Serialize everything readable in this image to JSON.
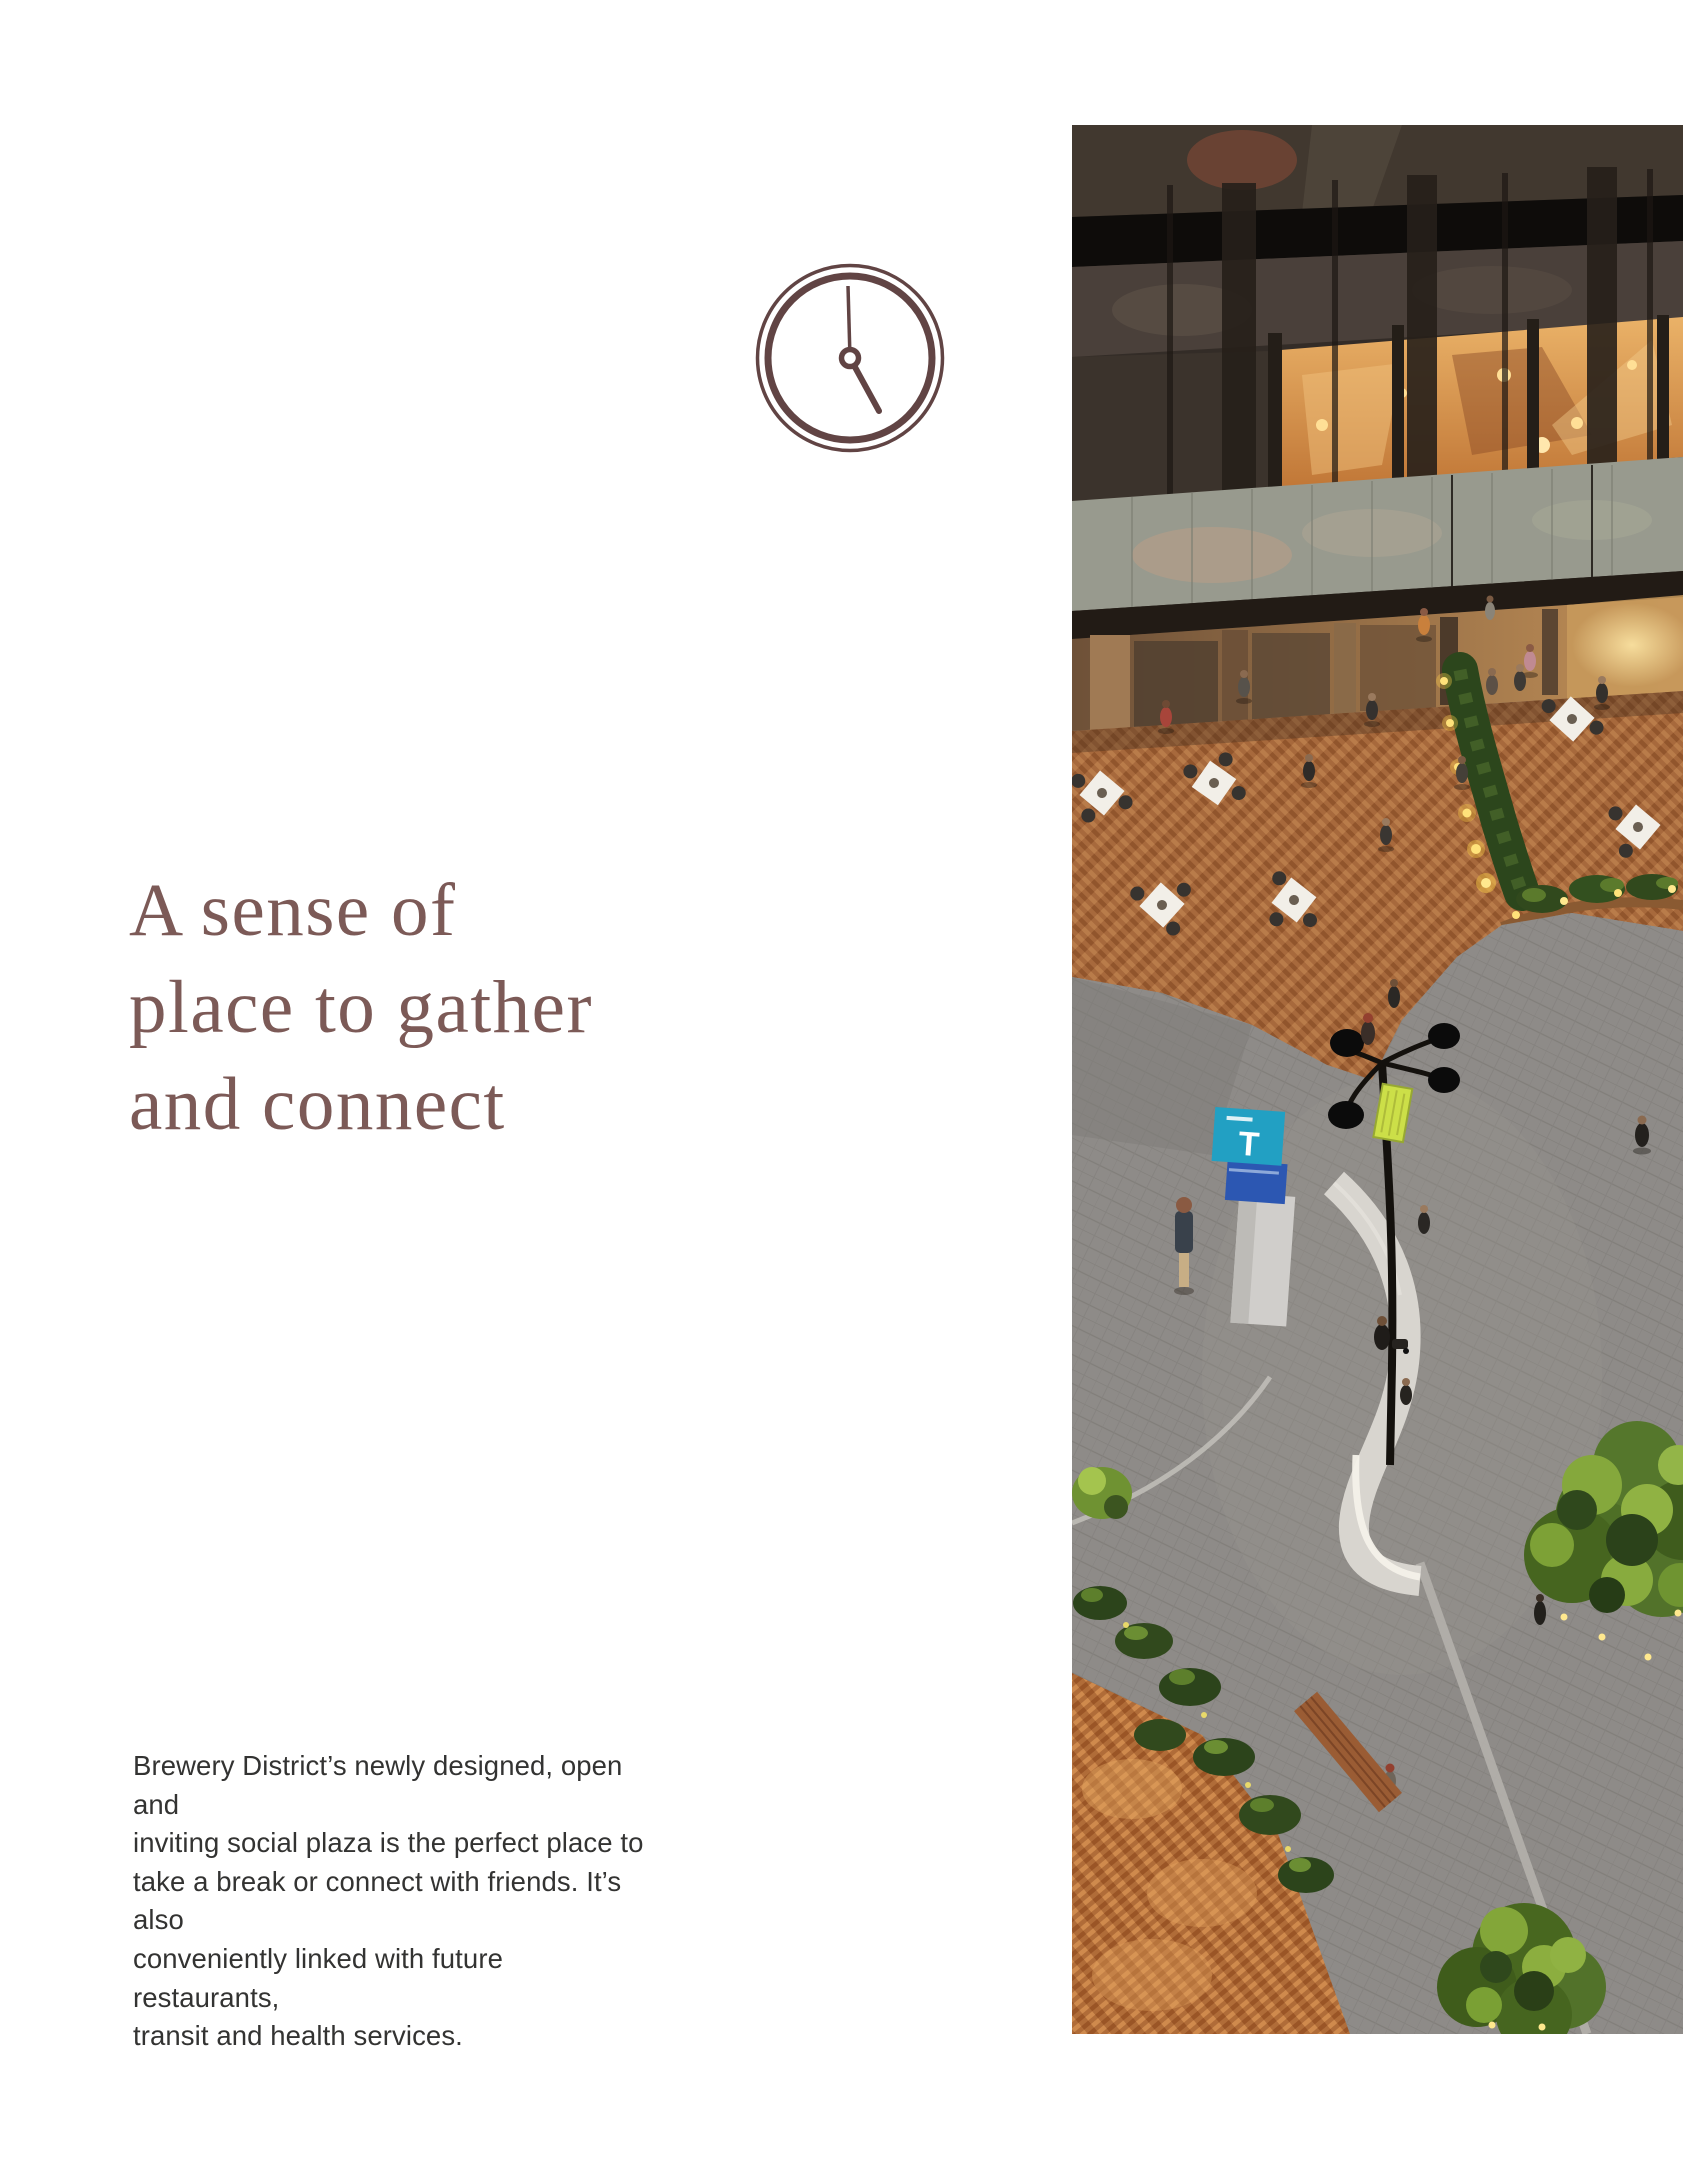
{
  "page": {
    "background": "#ffffff"
  },
  "heading": {
    "color": "#7c5a57",
    "lines": [
      "A sense of",
      "place to gather",
      "and connect"
    ]
  },
  "paragraph": {
    "color": "#333332",
    "lines": [
      "Brewery District’s newly designed, open and",
      "inviting social plaza is the perfect place to",
      "take a break or connect with friends. It’s also",
      "conveniently linked with future restaurants,",
      "transit and health services."
    ]
  },
  "clock": {
    "color": "#614444",
    "time_shown": "5:00"
  },
  "photo": {
    "alt": "Aerial evening rendering of a social plaza: lit building facade, herringbone brick terrace with cafe tables, grey paver street with transit sign, lamp post, curved bench and trees",
    "kiosk_label": "T",
    "accents": {
      "brick": "#a7693c",
      "street": "#8e8b88",
      "tree_green": "#86a83e",
      "kiosk_teal": "#22a0c3",
      "kiosk_blue": "#2c57b2",
      "banner_green": "#ccdf48",
      "warm_window": "#d9944f"
    }
  }
}
